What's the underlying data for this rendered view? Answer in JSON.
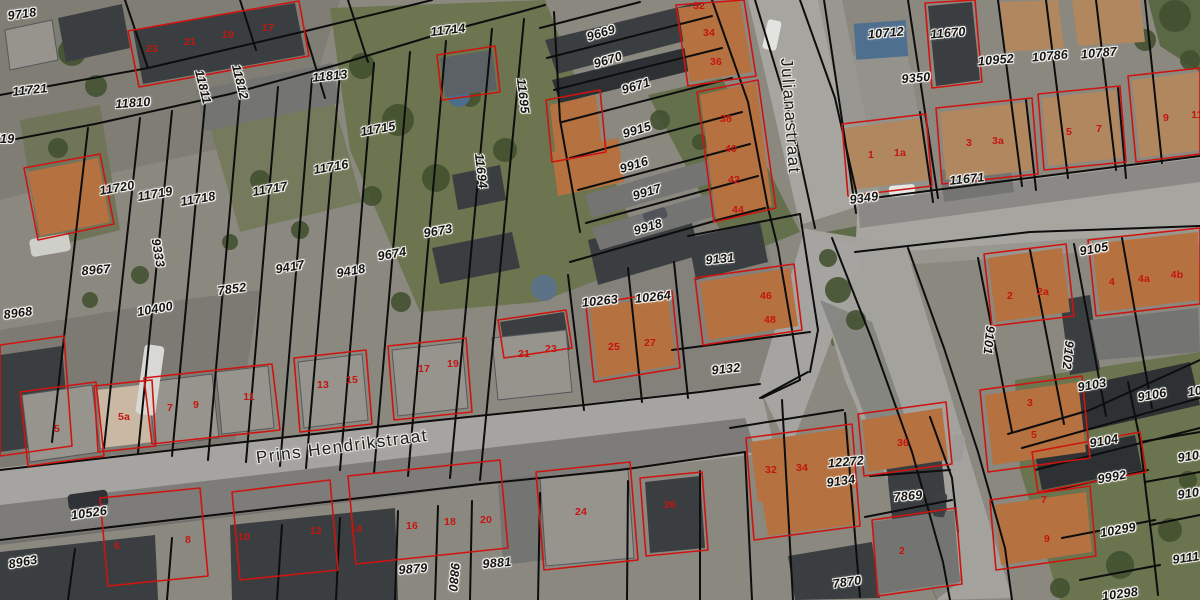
{
  "map": {
    "type": "cadastral-parcel-overlay-on-aerial-photo",
    "colors": {
      "parcel_line": "#0d0d0d",
      "building_outline_red": "#cf1410",
      "parcel_label_text": "#141414",
      "house_number_text": "#c41510",
      "road_fill": "#a6a5a0",
      "grass_fill": "#6c7550"
    },
    "street_labels": [
      {
        "t": "Prins Hendrikstraat",
        "x": 342,
        "y": 447,
        "r": -7.5
      },
      {
        "t": "Julianastraat",
        "x": 790,
        "y": 116,
        "r": 86
      }
    ],
    "parcel_labels": [
      {
        "t": "9718",
        "x": 22,
        "y": 14,
        "r": -8
      },
      {
        "t": "9719",
        "x": 0,
        "y": 139,
        "r": 0
      },
      {
        "t": "11721",
        "x": 30,
        "y": 90,
        "r": -6
      },
      {
        "t": "11810",
        "x": 133,
        "y": 103,
        "r": -4
      },
      {
        "t": "11811",
        "x": 203,
        "y": 87,
        "r": 76
      },
      {
        "t": "11812",
        "x": 240,
        "y": 82,
        "r": 76
      },
      {
        "t": "11813",
        "x": 330,
        "y": 76,
        "r": -6
      },
      {
        "t": "11714",
        "x": 448,
        "y": 30,
        "r": -7
      },
      {
        "t": "11695",
        "x": 523,
        "y": 96,
        "r": 83
      },
      {
        "t": "11715",
        "x": 378,
        "y": 129,
        "r": -10
      },
      {
        "t": "11716",
        "x": 331,
        "y": 167,
        "r": -10
      },
      {
        "t": "11717",
        "x": 270,
        "y": 189,
        "r": -10
      },
      {
        "t": "11718",
        "x": 198,
        "y": 199,
        "r": -10
      },
      {
        "t": "11719",
        "x": 155,
        "y": 194,
        "r": -10
      },
      {
        "t": "11720",
        "x": 117,
        "y": 188,
        "r": -10
      },
      {
        "t": "9333",
        "x": 158,
        "y": 253,
        "r": 80
      },
      {
        "t": "8967",
        "x": 96,
        "y": 270,
        "r": -5
      },
      {
        "t": "8968",
        "x": 18,
        "y": 313,
        "r": -8
      },
      {
        "t": "7852",
        "x": 232,
        "y": 289,
        "r": -8
      },
      {
        "t": "10400",
        "x": 155,
        "y": 309,
        "r": -10
      },
      {
        "t": "9417",
        "x": 290,
        "y": 267,
        "r": -10
      },
      {
        "t": "9418",
        "x": 351,
        "y": 271,
        "r": -10
      },
      {
        "t": "9674",
        "x": 392,
        "y": 254,
        "r": -10
      },
      {
        "t": "9673",
        "x": 438,
        "y": 231,
        "r": -10
      },
      {
        "t": "11694",
        "x": 481,
        "y": 171,
        "r": 83
      },
      {
        "t": "9669",
        "x": 601,
        "y": 33,
        "r": -17
      },
      {
        "t": "9670",
        "x": 608,
        "y": 60,
        "r": -17
      },
      {
        "t": "9671",
        "x": 636,
        "y": 86,
        "r": -17
      },
      {
        "t": "9915",
        "x": 637,
        "y": 130,
        "r": -17
      },
      {
        "t": "9916",
        "x": 634,
        "y": 165,
        "r": -17
      },
      {
        "t": "9917",
        "x": 647,
        "y": 192,
        "r": -17
      },
      {
        "t": "9918",
        "x": 648,
        "y": 227,
        "r": -17
      },
      {
        "t": "10263",
        "x": 600,
        "y": 301,
        "r": -6
      },
      {
        "t": "10264",
        "x": 653,
        "y": 297,
        "r": -6
      },
      {
        "t": "9131",
        "x": 720,
        "y": 259,
        "r": -6
      },
      {
        "t": "9132",
        "x": 726,
        "y": 369,
        "r": -6
      },
      {
        "t": "10712",
        "x": 886,
        "y": 33,
        "r": -5
      },
      {
        "t": "11670",
        "x": 948,
        "y": 33,
        "r": -5
      },
      {
        "t": "9350",
        "x": 916,
        "y": 78,
        "r": -5
      },
      {
        "t": "10952",
        "x": 996,
        "y": 60,
        "r": -5
      },
      {
        "t": "10786",
        "x": 1050,
        "y": 56,
        "r": -5
      },
      {
        "t": "10787",
        "x": 1099,
        "y": 53,
        "r": -5
      },
      {
        "t": "9349",
        "x": 864,
        "y": 198,
        "r": -8
      },
      {
        "t": "11671",
        "x": 967,
        "y": 179,
        "r": -6
      },
      {
        "t": "9105",
        "x": 1094,
        "y": 249,
        "r": -10
      },
      {
        "t": "9101",
        "x": 989,
        "y": 340,
        "r": 96
      },
      {
        "t": "9102",
        "x": 1068,
        "y": 355,
        "r": 96
      },
      {
        "t": "9103",
        "x": 1092,
        "y": 385,
        "r": -10
      },
      {
        "t": "9106",
        "x": 1152,
        "y": 395,
        "r": -10
      },
      {
        "t": "1014",
        "x": 1202,
        "y": 390,
        "r": -10
      },
      {
        "t": "9108",
        "x": 1192,
        "y": 456,
        "r": -8
      },
      {
        "t": "9109",
        "x": 1192,
        "y": 493,
        "r": -8
      },
      {
        "t": "9104",
        "x": 1104,
        "y": 441,
        "r": -10
      },
      {
        "t": "9992",
        "x": 1112,
        "y": 477,
        "r": -10
      },
      {
        "t": "10299",
        "x": 1118,
        "y": 530,
        "r": -10
      },
      {
        "t": "9111",
        "x": 1186,
        "y": 558,
        "r": -8
      },
      {
        "t": "10298",
        "x": 1120,
        "y": 594,
        "r": -8
      },
      {
        "t": "10526",
        "x": 89,
        "y": 513,
        "r": -8
      },
      {
        "t": "8963",
        "x": 23,
        "y": 562,
        "r": -10
      },
      {
        "t": "9879",
        "x": 413,
        "y": 569,
        "r": -5
      },
      {
        "t": "9880",
        "x": 454,
        "y": 577,
        "r": 95
      },
      {
        "t": "9881",
        "x": 497,
        "y": 563,
        "r": -5
      },
      {
        "t": "12272",
        "x": 846,
        "y": 462,
        "r": -5
      },
      {
        "t": "9134",
        "x": 841,
        "y": 481,
        "r": -8
      },
      {
        "t": "7869",
        "x": 908,
        "y": 496,
        "r": -5
      },
      {
        "t": "7870",
        "x": 847,
        "y": 582,
        "r": -8
      }
    ],
    "house_number_labels": [
      {
        "t": "23",
        "x": 152,
        "y": 49
      },
      {
        "t": "21",
        "x": 190,
        "y": 42
      },
      {
        "t": "19",
        "x": 228,
        "y": 35
      },
      {
        "t": "17",
        "x": 268,
        "y": 28
      },
      {
        "t": "32",
        "x": 699,
        "y": 6
      },
      {
        "t": "34",
        "x": 709,
        "y": 33
      },
      {
        "t": "36",
        "x": 716,
        "y": 62
      },
      {
        "t": "38",
        "x": 726,
        "y": 119
      },
      {
        "t": "40",
        "x": 731,
        "y": 149
      },
      {
        "t": "42",
        "x": 734,
        "y": 180
      },
      {
        "t": "44",
        "x": 738,
        "y": 210
      },
      {
        "t": "1",
        "x": 871,
        "y": 155
      },
      {
        "t": "1a",
        "x": 900,
        "y": 153
      },
      {
        "t": "3",
        "x": 969,
        "y": 143
      },
      {
        "t": "3a",
        "x": 998,
        "y": 141
      },
      {
        "t": "5",
        "x": 1069,
        "y": 132
      },
      {
        "t": "7",
        "x": 1099,
        "y": 129
      },
      {
        "t": "9",
        "x": 1166,
        "y": 118
      },
      {
        "t": "11",
        "x": 1197,
        "y": 115
      },
      {
        "t": "2",
        "x": 1010,
        "y": 296
      },
      {
        "t": "2a",
        "x": 1043,
        "y": 292
      },
      {
        "t": "4",
        "x": 1112,
        "y": 282
      },
      {
        "t": "4a",
        "x": 1144,
        "y": 279
      },
      {
        "t": "4b",
        "x": 1177,
        "y": 275
      },
      {
        "t": "25",
        "x": 614,
        "y": 347
      },
      {
        "t": "27",
        "x": 650,
        "y": 343
      },
      {
        "t": "46",
        "x": 766,
        "y": 296
      },
      {
        "t": "48",
        "x": 770,
        "y": 320
      },
      {
        "t": "5",
        "x": 57,
        "y": 429
      },
      {
        "t": "5a",
        "x": 124,
        "y": 417
      },
      {
        "t": "7",
        "x": 170,
        "y": 408
      },
      {
        "t": "9",
        "x": 196,
        "y": 405
      },
      {
        "t": "11",
        "x": 249,
        "y": 397
      },
      {
        "t": "13",
        "x": 323,
        "y": 385
      },
      {
        "t": "15",
        "x": 352,
        "y": 380
      },
      {
        "t": "17",
        "x": 424,
        "y": 369
      },
      {
        "t": "19",
        "x": 453,
        "y": 364
      },
      {
        "t": "21",
        "x": 524,
        "y": 354
      },
      {
        "t": "23",
        "x": 551,
        "y": 349
      },
      {
        "t": "6",
        "x": 117,
        "y": 546
      },
      {
        "t": "8",
        "x": 188,
        "y": 540
      },
      {
        "t": "10",
        "x": 244,
        "y": 537
      },
      {
        "t": "12",
        "x": 316,
        "y": 531
      },
      {
        "t": "14",
        "x": 356,
        "y": 529
      },
      {
        "t": "16",
        "x": 412,
        "y": 526
      },
      {
        "t": "18",
        "x": 450,
        "y": 522
      },
      {
        "t": "20",
        "x": 486,
        "y": 520
      },
      {
        "t": "24",
        "x": 581,
        "y": 512
      },
      {
        "t": "26",
        "x": 670,
        "y": 505
      },
      {
        "t": "32",
        "x": 771,
        "y": 470
      },
      {
        "t": "34",
        "x": 802,
        "y": 468
      },
      {
        "t": "36",
        "x": 903,
        "y": 443
      },
      {
        "t": "2",
        "x": 902,
        "y": 551
      },
      {
        "t": "3",
        "x": 1030,
        "y": 403
      },
      {
        "t": "5",
        "x": 1034,
        "y": 435
      },
      {
        "t": "7",
        "x": 1044,
        "y": 500
      },
      {
        "t": "9",
        "x": 1047,
        "y": 539
      }
    ]
  }
}
